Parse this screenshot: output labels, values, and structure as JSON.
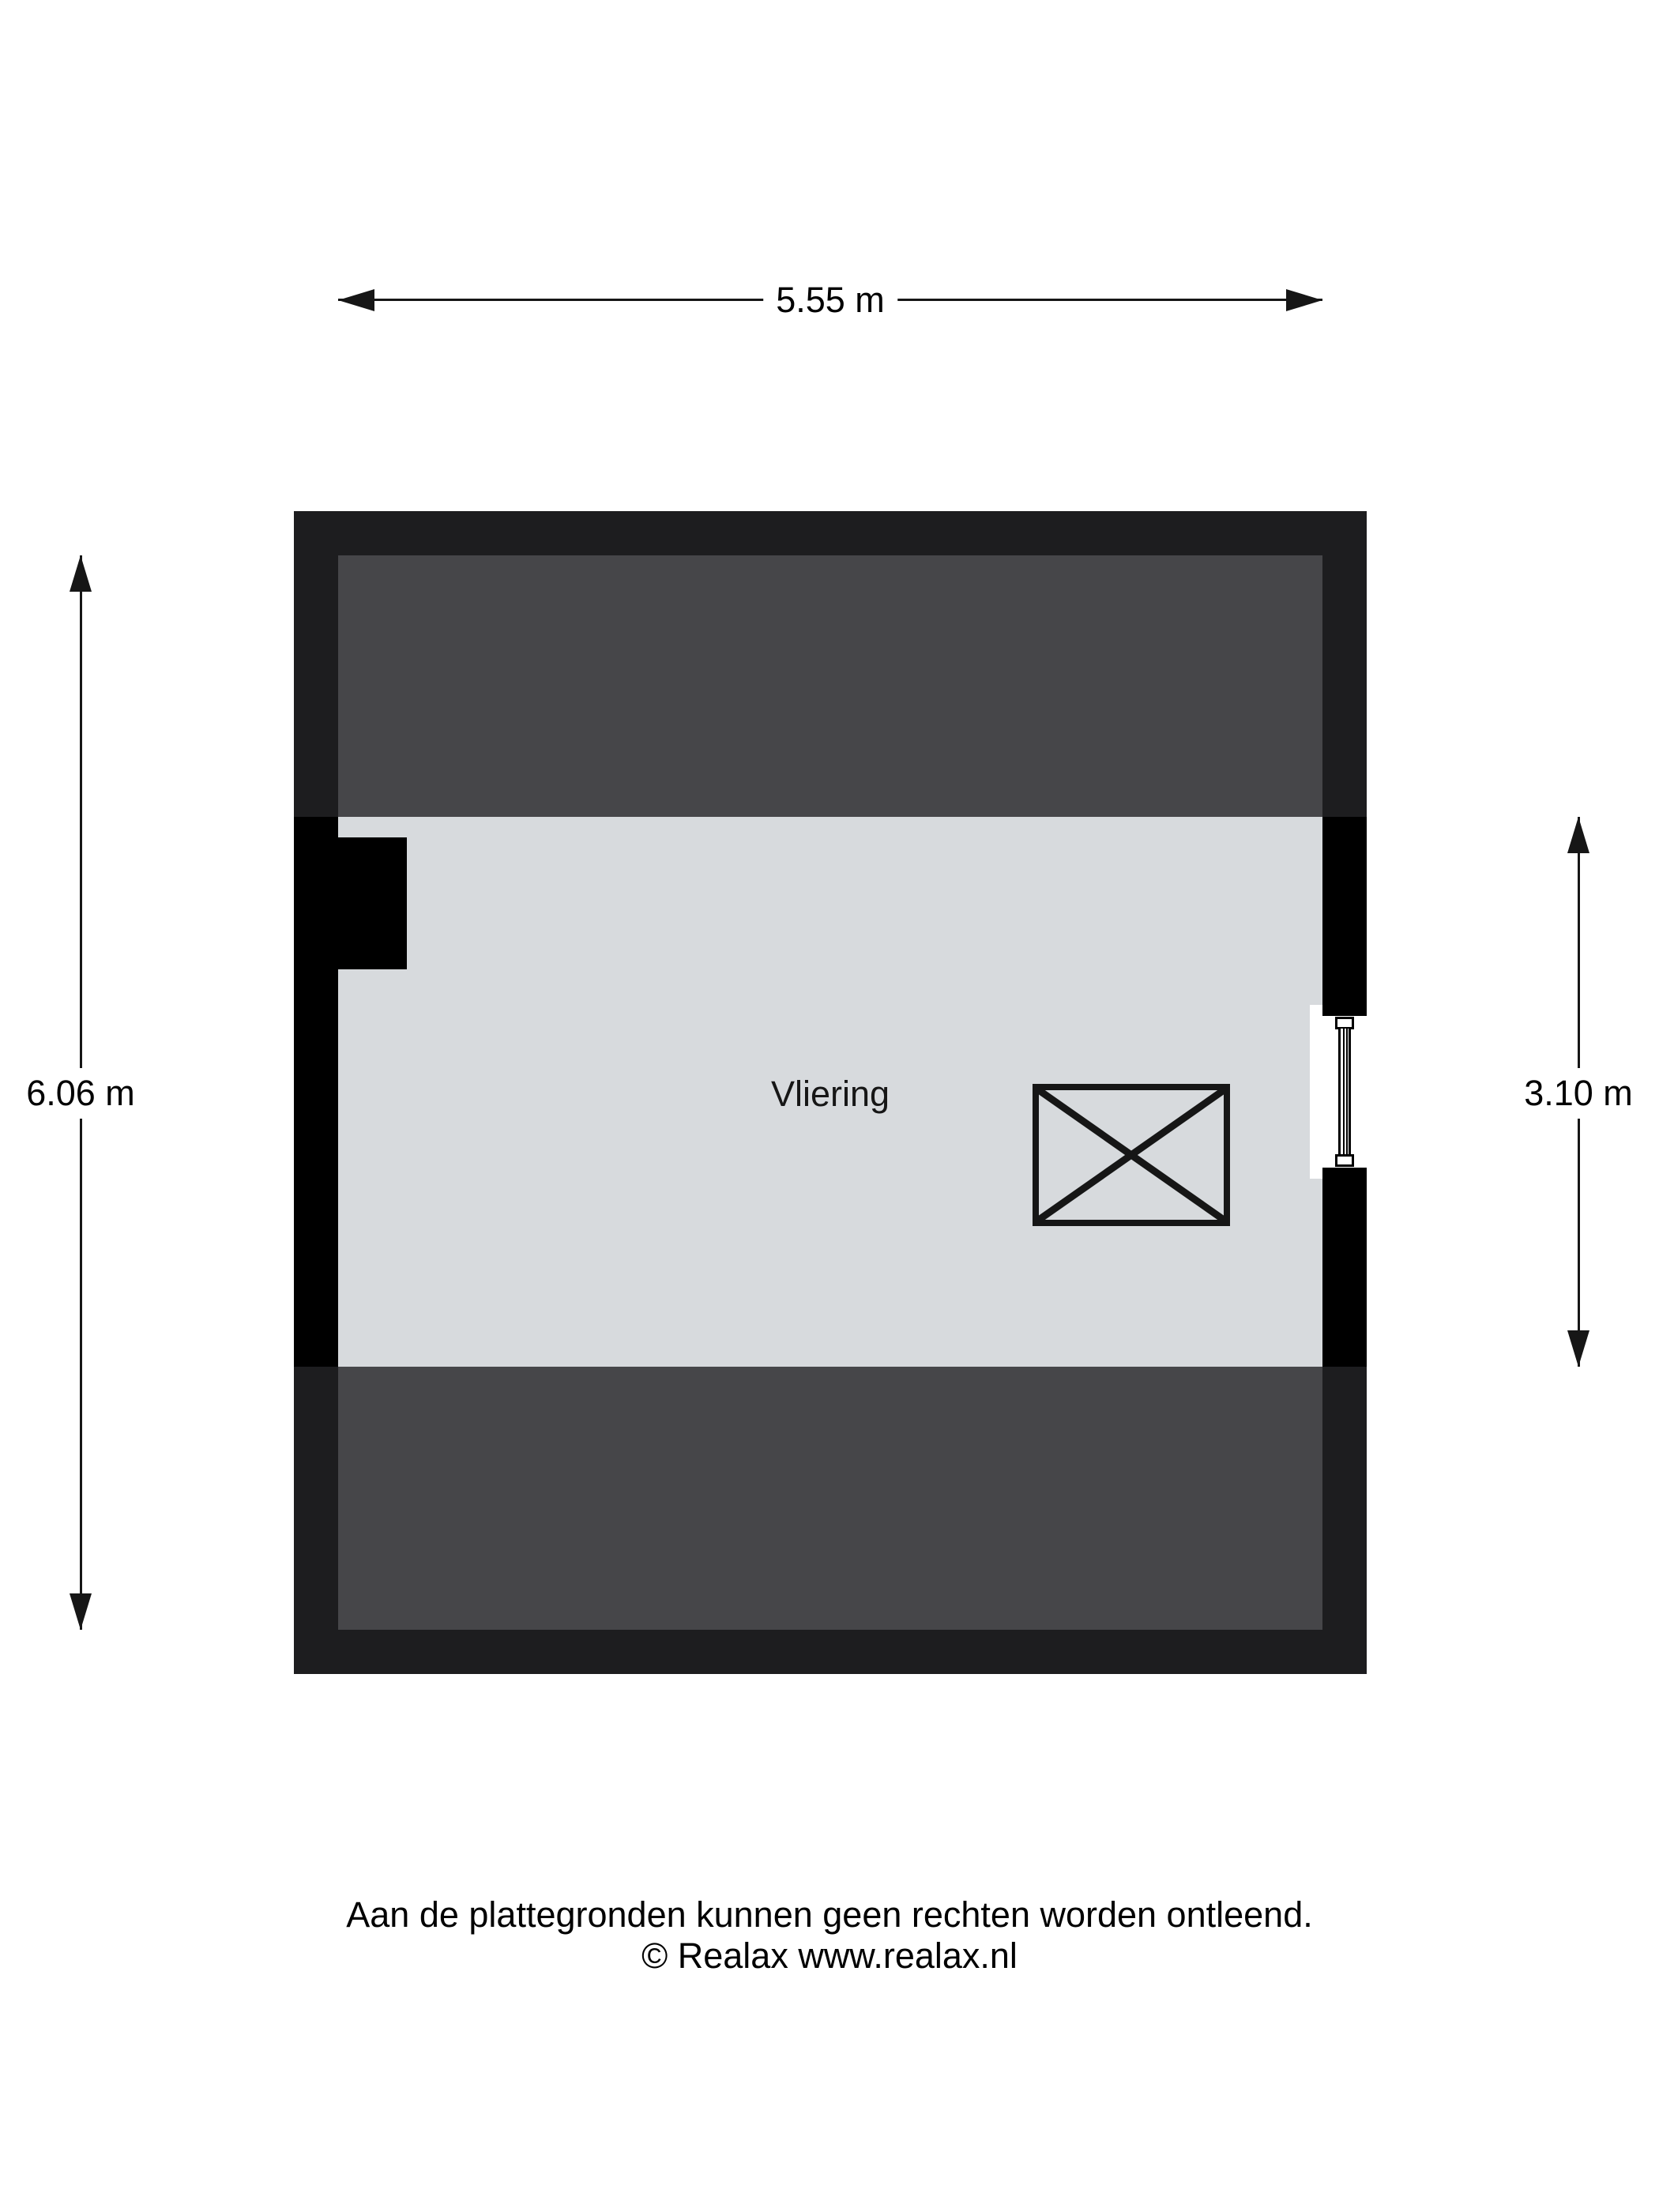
{
  "floorplan": {
    "room_label": "Vliering",
    "colors": {
      "wall_black": "#000000",
      "wall_dark": "#1d1d1f",
      "low_headroom_fill": "#464649",
      "floor_fill": "#d7dadd",
      "line": "#161616",
      "page_bg": "#ffffff"
    }
  },
  "dimensions": {
    "top": "5.55 m",
    "left": "6.06 m",
    "right": "3.10 m"
  },
  "footer": {
    "disclaimer": "Aan de plattegronden kunnen geen rechten worden ontleend.",
    "copyright": "© Realax www.realax.nl"
  }
}
